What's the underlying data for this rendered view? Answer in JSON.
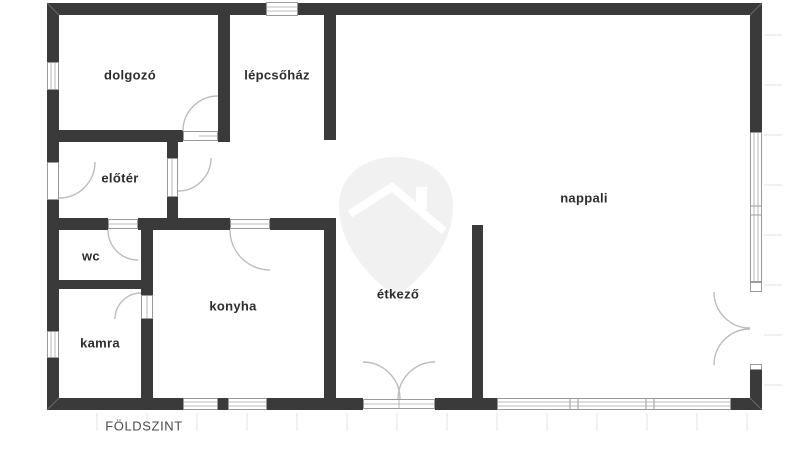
{
  "floor_plan": {
    "title": "FÖLDSZINT",
    "rooms": [
      {
        "id": "dolgozo",
        "label": "dolgozó"
      },
      {
        "id": "lepcsohaz",
        "label": "lépcsőház"
      },
      {
        "id": "eloter",
        "label": "előtér"
      },
      {
        "id": "wc",
        "label": "wc"
      },
      {
        "id": "kamra",
        "label": "kamra"
      },
      {
        "id": "konyha",
        "label": "konyha"
      },
      {
        "id": "etkezo",
        "label": "étkező"
      },
      {
        "id": "nappali",
        "label": "nappali"
      }
    ],
    "watermark_icon": "house-pin-watermark",
    "colors": {
      "wall": "#3a3a3a",
      "door_arc": "#bdbdbd",
      "window_frame": "#9a9a9a",
      "watermark": "#f1f1f1",
      "label_text": "#2d2d2d",
      "title_text": "#4a4a4a"
    }
  }
}
